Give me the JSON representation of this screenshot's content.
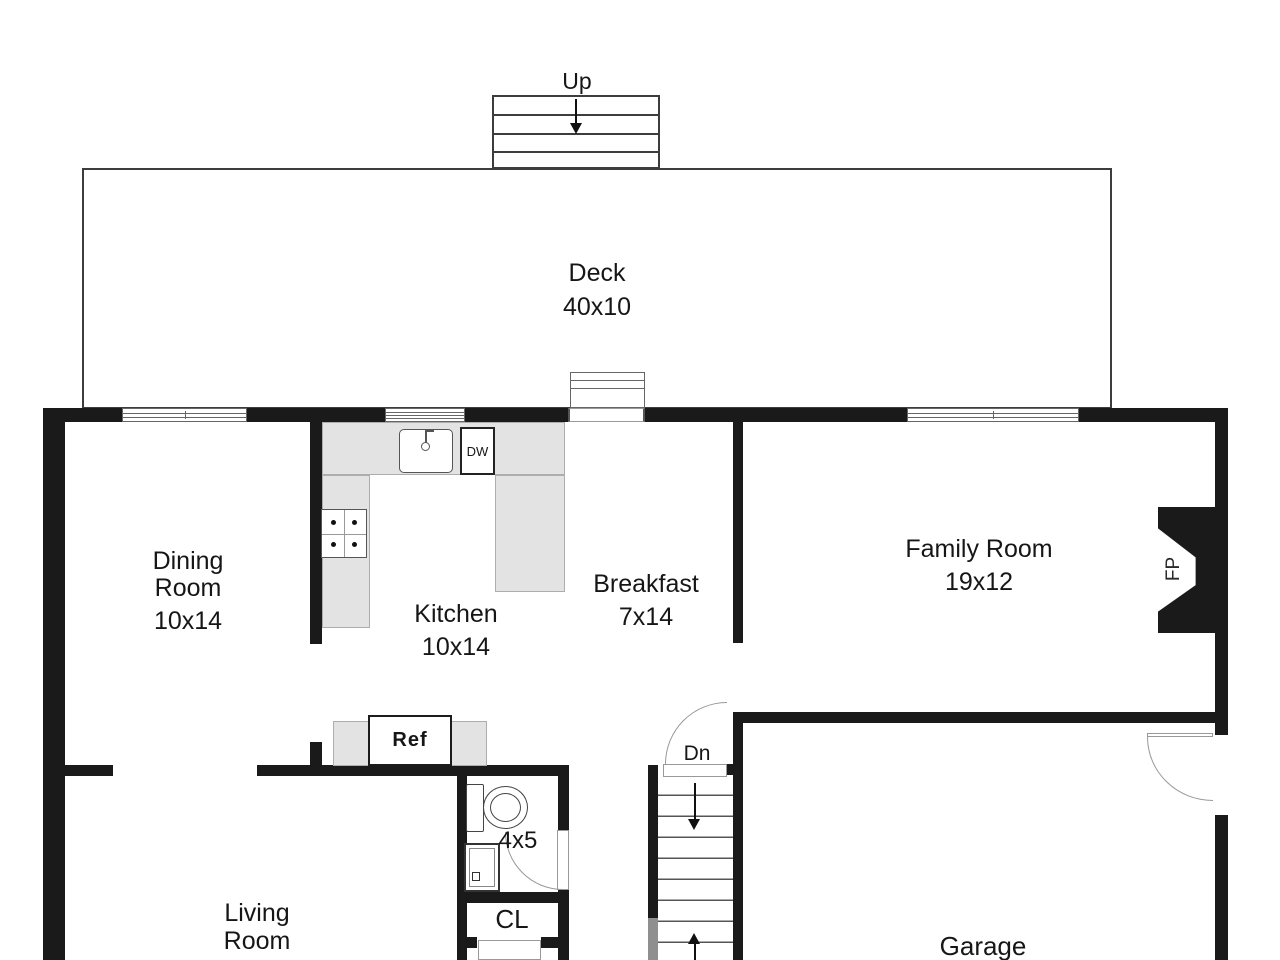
{
  "colors": {
    "wall": "#1a1a1a",
    "counter": "#e3e3e3",
    "counter_border": "#adadad",
    "stair_gray": "#8f8f8f"
  },
  "plan": {
    "deck": {
      "name": "Deck",
      "dims": "40x10"
    },
    "upper_stairs": {
      "label": "Up"
    },
    "dining_room": {
      "line1": "Dining",
      "line2": "Room",
      "dims": "10x14"
    },
    "kitchen": {
      "name": "Kitchen",
      "dims": "10x14",
      "dishwasher_label": "DW"
    },
    "breakfast": {
      "name": "Breakfast",
      "dims": "7x14"
    },
    "family_room": {
      "name": "Family Room",
      "dims": "19x12",
      "fireplace_label": "FP"
    },
    "refrigerator": {
      "label": "Ref"
    },
    "stairs_down": {
      "label": "Dn"
    },
    "bathroom": {
      "dims": "4x5"
    },
    "closet": {
      "label": "CL"
    },
    "living_room": {
      "line1": "Living",
      "line2": "Room",
      "dims": "16x12"
    },
    "garage": {
      "name": "Garage"
    }
  }
}
